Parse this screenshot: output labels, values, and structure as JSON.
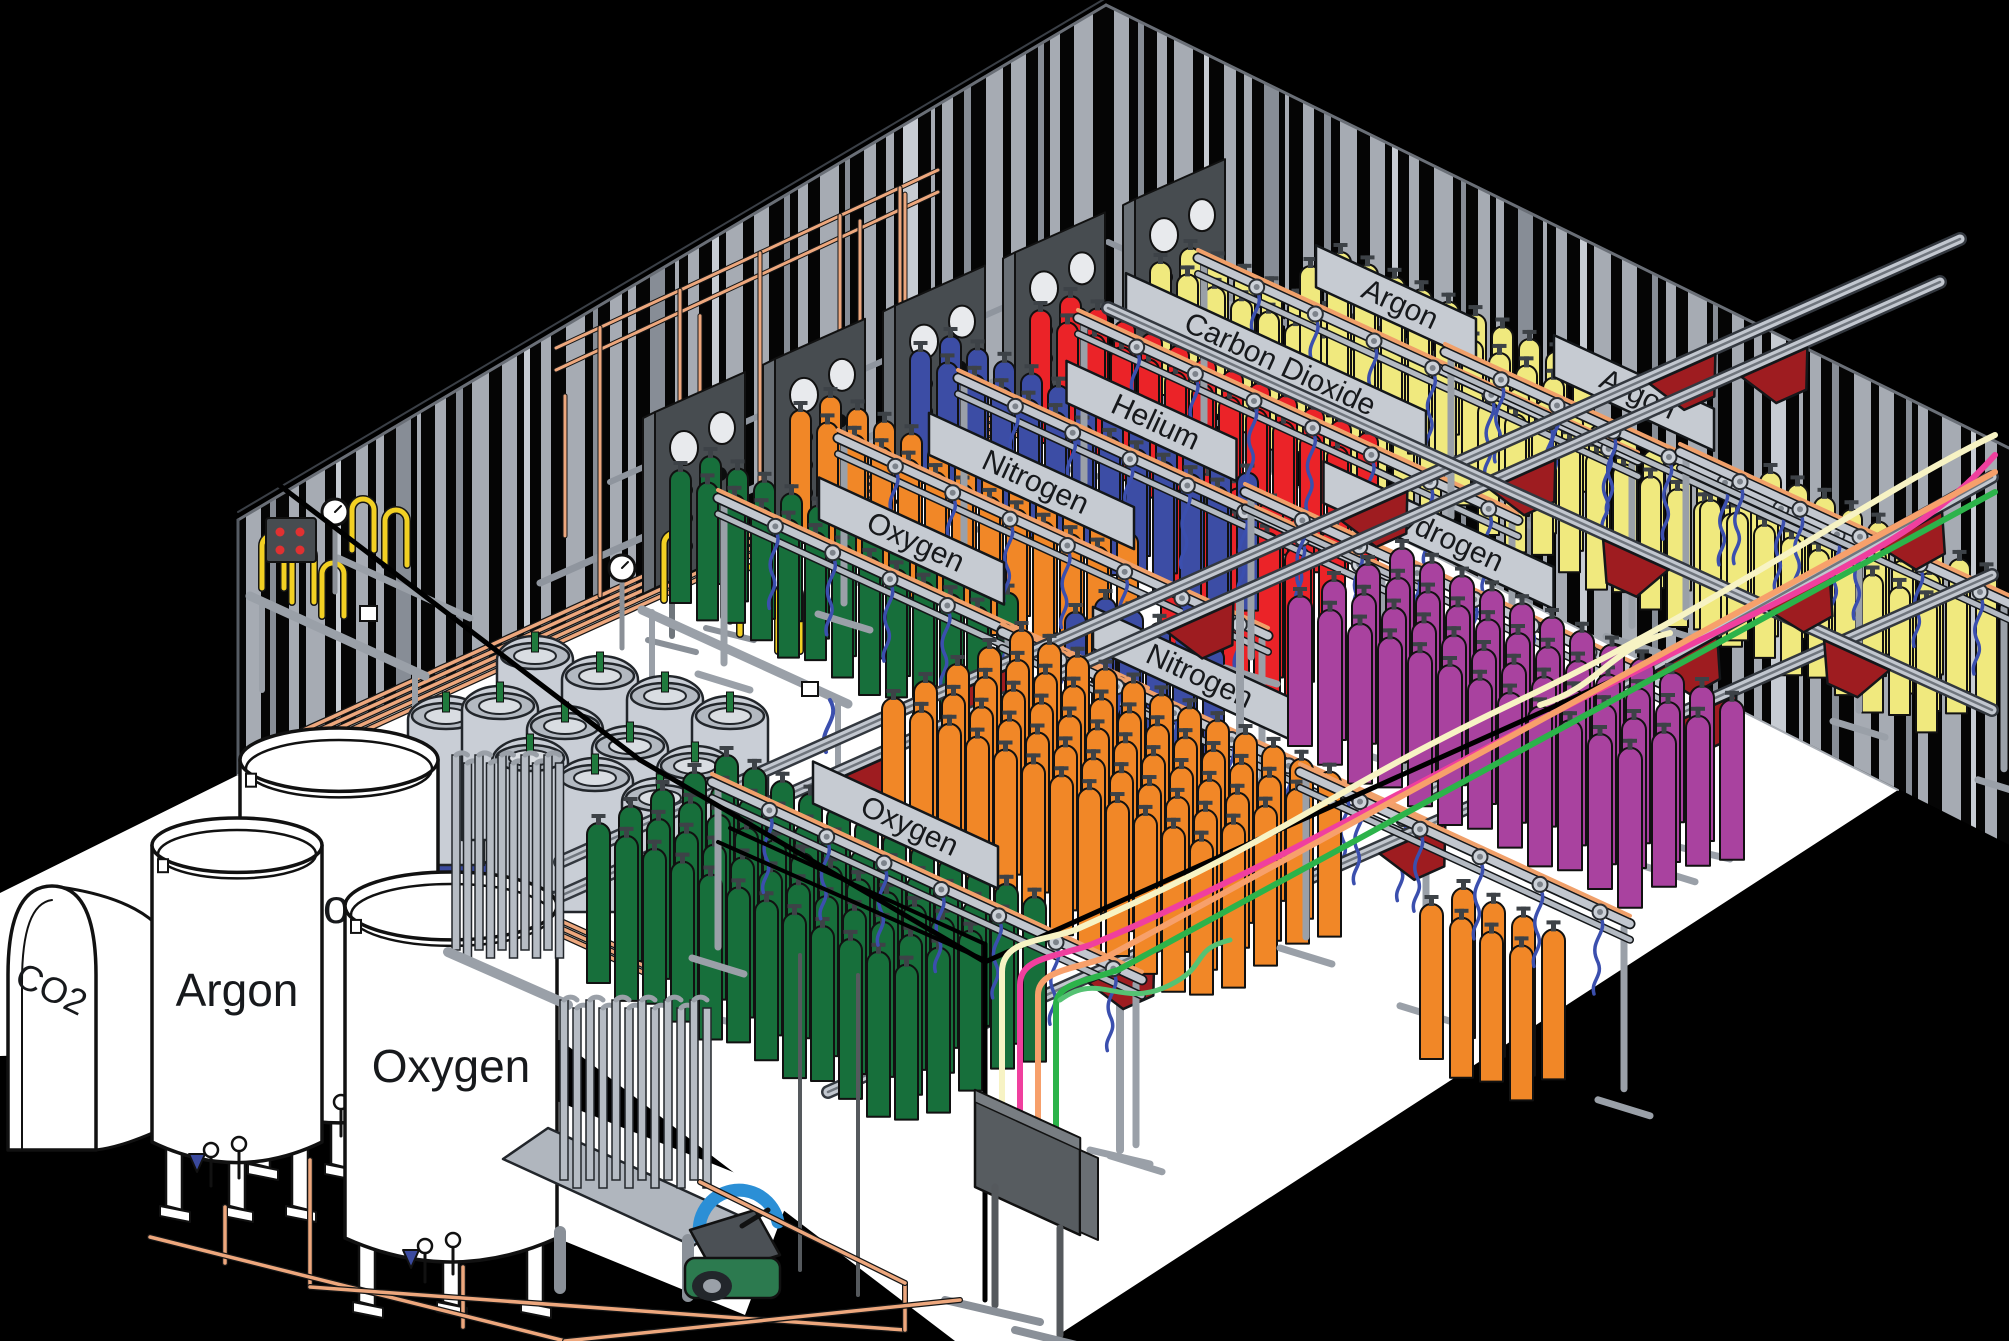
{
  "illustration": {
    "subject": "isometric-gas-cylinder-filling-plant"
  },
  "rack_signs": [
    {
      "id": "oxygen-upper",
      "label": "Oxygen"
    },
    {
      "id": "nitrogen-upper",
      "label": "Nitrogen"
    },
    {
      "id": "helium",
      "label": "Helium"
    },
    {
      "id": "carbon-dioxide",
      "label": "Carbon Dioxide"
    },
    {
      "id": "argon-back",
      "label": "Argon"
    },
    {
      "id": "hydrogen",
      "label": "Hydrogen"
    },
    {
      "id": "nitrogen-lower",
      "label": "Nitrogen"
    },
    {
      "id": "oxygen-lower",
      "label": "Oxygen"
    },
    {
      "id": "argon-right",
      "label": "Argon"
    }
  ],
  "bulk_tanks": [
    {
      "id": "co2-tank",
      "label": "CO2"
    },
    {
      "id": "argon-tank",
      "label": "Argon"
    },
    {
      "id": "nitrogen-tank",
      "label": "Nitrogen"
    },
    {
      "id": "oxygen-tank",
      "label": "Oxygen"
    }
  ],
  "gas_cylinder_colors": {
    "oxygen_green": "#176f3b",
    "nitrogen_orange": "#f18727",
    "nitrogen_blue": "#3c4da5",
    "helium_red": "#eb2328",
    "co2_argon_yellow": "#f0e97e",
    "hydrogen_purple": "#a9429f",
    "dewar_gray": "#c9ced6"
  },
  "palette": {
    "background": "#000000",
    "floor": "#ffffff",
    "wall_stripe": "#a6abb3",
    "wall_stripe_light": "#c7ccd3",
    "wall_stripe_dark": "#878d96",
    "copper": "#eda77d",
    "rail_gray": "#c2c7cf",
    "rail_gray2": "#b4bac2",
    "rail_shadow": "#14171a",
    "rail_stripe": "#f0a06a",
    "beam_gray": "#c2c7cf",
    "beam_dark": "#33383f",
    "sign_gray": "#c6cbd2",
    "panel_dark": "#474c50",
    "panel_side": "#6a7076",
    "carrier_red": "#9e1c20",
    "pallet_blue": "#3b4a9e",
    "hose_blue": "#3b4fae",
    "pigtail_yellow": "#f2d023",
    "post_gray": "#9aa0a8",
    "dewar_collar": "#b3b9c1",
    "line_cream": "#f7f3c4",
    "line_pink": "#f03f9e",
    "line_salmon": "#f7a06b",
    "line_green": "#2cb34a",
    "line_green_light": "#55c273",
    "pump_green": "#2c7a4f",
    "pump_blue": "#2b8fd6",
    "pump_body": "#4b5055",
    "indicator_red": "#e03131"
  }
}
